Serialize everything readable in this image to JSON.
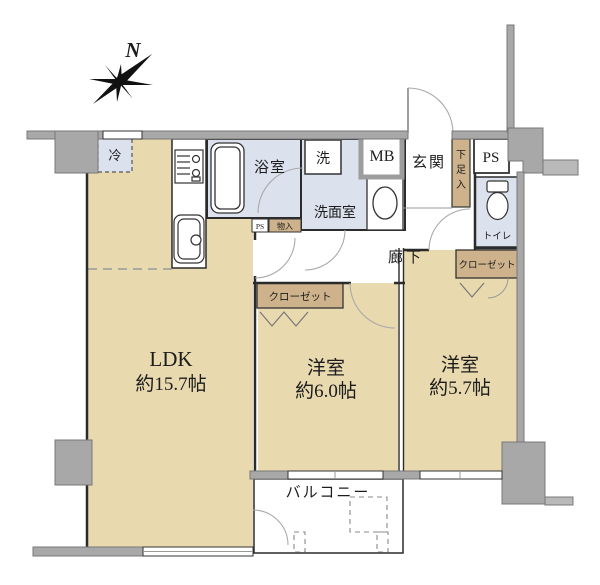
{
  "plan": {
    "compass_label": "N",
    "colors": {
      "room_beige": "#e8d9ae",
      "wet_blue": "#dce1ee",
      "closet_tan": "#cdb28b",
      "wall_gray": "#a8a8a8",
      "line_dark": "#2b2b2b"
    },
    "rooms": {
      "ldk": {
        "name": "LDK",
        "size": "約15.7帖"
      },
      "bedroom1": {
        "name": "洋室",
        "size": "約6.0帖"
      },
      "bedroom2": {
        "name": "洋室",
        "size": "約5.7帖"
      },
      "balcony": {
        "label": "バルコニー"
      },
      "bath": {
        "label": "浴室"
      },
      "washroom": {
        "label": "洗面室"
      },
      "washer": {
        "label": "洗"
      },
      "meter_box": {
        "label": "MB"
      },
      "entrance": {
        "label": "玄関"
      },
      "shoe_box": {
        "label": "下足入",
        "c1": "下",
        "c2": "足",
        "c3": "入"
      },
      "pipe_space": {
        "label": "PS"
      },
      "pipe_space_small": {
        "label": "PS"
      },
      "storage_small": {
        "label": "物入"
      },
      "toilet": {
        "label": "トイレ"
      },
      "hallway": {
        "label": "廊下"
      },
      "closet_main": {
        "label": "クローゼット"
      },
      "closet_second": {
        "label": "クローゼット"
      },
      "fridge": {
        "label": "冷"
      }
    }
  }
}
